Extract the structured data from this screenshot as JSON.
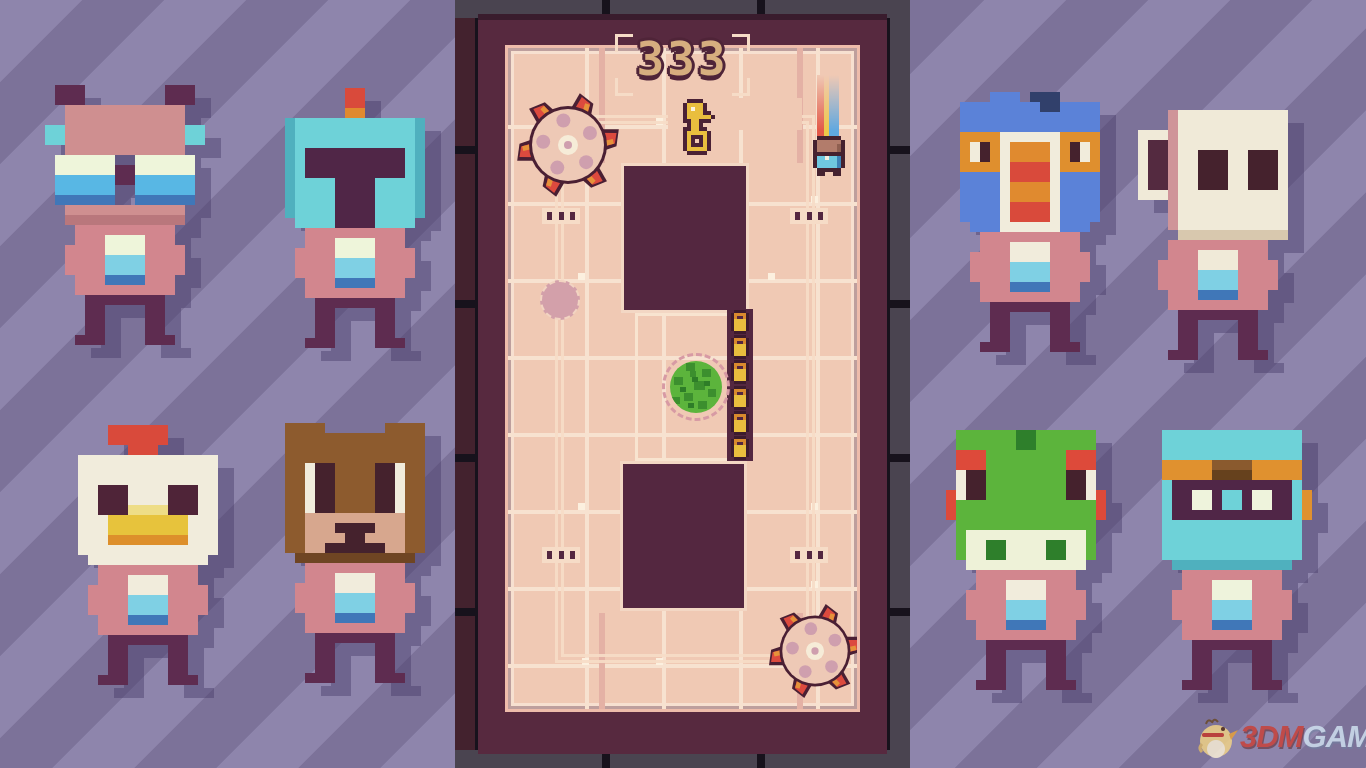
{
  "hud": {
    "score": "333"
  },
  "board": {
    "key_tokens": 6
  },
  "watermark": {
    "brand": "3DM",
    "suffix": "GAME"
  },
  "roster": {
    "left": [
      "bat",
      "knight",
      "chicken",
      "bear"
    ],
    "right": [
      "turkey",
      "mug",
      "frog",
      "aviator"
    ]
  },
  "palette": {
    "background_light": "#8e85ac",
    "background_dark": "#7c7299",
    "wall": "#57293f",
    "floor": "#f0c9b4",
    "pit": "#542740",
    "gold": "#e9be3e",
    "saw": {
      "outline": "#4a1f33",
      "red": "#dc4a3e",
      "orange": "#e6923a",
      "body": "#eec9b6",
      "petal": "#cf9fae",
      "core": "#f6ecd8"
    },
    "bush": {
      "leaf": "#5cb43c",
      "leafDark": "#3c8f2e",
      "leafDeep": "#2e7d28"
    },
    "watermark_red": "#c8413a",
    "watermark_blue": "#cfe0ef"
  },
  "sprites": {
    "char_bat": {
      "palette": {
        "E": "#5e2c50",
        "H": "#cf8f90",
        "h": "#b9777c",
        "C": "#6ed2d8",
        "W": "#eef5da",
        "U": "#58b7e4",
        "D": "#4077b8",
        "S": "#d2868e",
        "A": "#d2868e",
        "B": "#7fd0e4",
        "L": "#5e2c50"
      },
      "grid": [
        ".EEE........EEE.",
        ".EEE........EEE.",
        "..HHHHHHHHHHHH..",
        "..HHHHHHHHHHHH..",
        "CCHHHHHHHHHHHHCC",
        "CCHHHHHHHHHHHHCC",
        "..HHHHHHHHHHHH..",
        ".WWWWWW..WWWWWW.",
        ".WWWWWWEEWWWWWW.",
        ".UUUUUUEEUUUUUU.",
        ".UUUUUU..UUUUUU.",
        ".DDDDDD..DDDDDD.",
        "..HHHHHHHHHHHH..",
        "..hhhhhhhhhhhh..",
        "...SSSSSSSSSS...",
        "...SSSWWWWSSS...",
        "..ASSSWWWWSSSA..",
        "..ASSSBBBBSSSA..",
        "..ASSSBBBBSSSA..",
        "...SSSDDDDSSS...",
        "...SSSSSSSSSS...",
        "....LLLLLLLL....",
        "....LL....LL....",
        "....LL....LL....",
        "....LL....LL....",
        "...LLL....LLL..."
      ]
    },
    "char_knight": {
      "palette": {
        "R": "#d94a3b",
        "N": "#e08a2f",
        "K": "#6ed2d8",
        "k": "#4fb0be",
        "V": "#502647",
        "W": "#eef5da",
        "S": "#d2868e",
        "A": "#d2868e",
        "B": "#7fd0e4",
        "D": "#4077b8",
        "L": "#5e2c50"
      },
      "grid": [
        ".......RR.......",
        ".......RR.......",
        ".......NN.......",
        ".kKKKKKKKKKKKKk.",
        ".kKKKKKKKKKKKKk.",
        ".kKKKKKKKKKKKKk.",
        ".kKVVVVVVVVVVKk.",
        ".kKVVVVVVVVVVKk.",
        ".kKVVVVVVVVVVKk.",
        ".kKKKKVVVVKKKKk.",
        ".kKKKKVVVVKKKKk.",
        ".kKKKKVVVVKKKKk.",
        ".kKKKKVVVVKKKKk.",
        "..KKKKVVVVKKKK..",
        "...SSSSSSSSSS...",
        "...SSSWWWWSSS...",
        "..ASSSWWWWSSSA..",
        "..ASSSBBBBSSSA..",
        "..ASSSBBBBSSSA..",
        "...SSSDDDDSSS...",
        "...SSSSSSSSSS...",
        "....LLLLLLLL....",
        "....LL....LL....",
        "....LL....LL....",
        "....LL....LL....",
        "...LLL....LLL..."
      ]
    },
    "char_chicken": {
      "palette": {
        "R": "#d94a3b",
        "W": "#f1ecdc",
        "E": "#4f2438",
        "Y": "#eedd86",
        "y": "#e7c33c",
        "N": "#dd8f2b",
        "S": "#d2868e",
        "A": "#d2868e",
        "B": "#7fd0e4",
        "D": "#4077b8",
        "L": "#5e2c50"
      },
      "grid": [
        "....RRRRRR......",
        "....RRRRRR......",
        "......RRR.......",
        ".WWWWWWWWWWWWWW.",
        ".WWWWWWWWWWWWWW.",
        ".WWWWWWWWWWWWWW.",
        ".WWEEEWWWWEEEWW.",
        ".WWEEEWWWWEEEWW.",
        ".WWEEEYYYYEEEWW.",
        ".WWWyyyyyyyyWWW.",
        ".WWWyyyyyyyyWWW.",
        ".WWWNNNNNNNNWWW.",
        ".WWWWWWWWWWWWWW.",
        "..WWWWWWWWWWWW..",
        "...SSSSSSSSSS...",
        "...SSSWWWWSSS...",
        "..ASSSWWWWSSSA..",
        "..ASSSBBBBSSSA..",
        "..ASSSBBBBSSSA..",
        "...SSSDDDDSSS...",
        "...SSSSSSSSSS...",
        "....LLLLLLLL....",
        "....LL....LL....",
        "....LL....LL....",
        "....LL....LL....",
        "...LLL....LLL..."
      ]
    },
    "char_bear": {
      "palette": {
        "F": "#8d5b2e",
        "f": "#6f4523",
        "W": "#f1ecdc",
        "E": "#45222d",
        "M": "#d7a78e",
        "S": "#d2868e",
        "A": "#d2868e",
        "B": "#7fd0e4",
        "D": "#4077b8",
        "L": "#5e2c50"
      },
      "grid": [
        ".FFFF......FFFF.",
        ".FFFFFFFFFFFFFF.",
        ".FFFFFFFFFFFFFF.",
        ".FFFFFFFFFFFFFF.",
        ".FFWEEFFFFEEWFF.",
        ".FFWEEFFFFEEWFF.",
        ".FFWEEFFFFEEWFF.",
        ".FFWEEFFFFEEWFF.",
        ".FFWEEFFFFEEWFF.",
        ".FFMMMMMMMMMMFF.",
        ".FFMMMEEEEMMMFF.",
        ".FFMMMMEEMMMMFF.",
        ".FFMMEEEEEEMMFF.",
        "..ffffffffffff..",
        "...SSSSSSSSSS...",
        "...SSSWWWWSSS...",
        "..ASSSWWWWSSSA..",
        "..ASSSBBBBSSSA..",
        "..ASSSBBBBSSSA..",
        "...SSSDDDDSSS...",
        "...SSSSSSSSSS...",
        "....LLLLLLLL....",
        "....LL....LL....",
        "....LL....LL....",
        "....LL....LL....",
        "...LLL....LLL..."
      ]
    },
    "char_turkey": {
      "palette": {
        "U": "#5b82d8",
        "u": "#31406b",
        "N": "#df8f2e",
        "n": "#e08a2f",
        "r": "#d94a3b",
        "W": "#f1ecdc",
        "E": "#45222d",
        "S": "#d2868e",
        "A": "#d2868e",
        "B": "#7fd0e4",
        "D": "#4077b8",
        "L": "#5e2c50"
      },
      "grid": [
        "....UUU.uuu.....",
        ".UUUUUUUUuuUUUU.",
        ".UUUUUUUUUUUUUU.",
        ".UUUUUUUUUUUUUU.",
        ".NNNNWWWWWWNNNN.",
        ".NWENWnnnnWNEWN.",
        ".NWENWnnnnWNEWN.",
        ".NNNNWrrrrWNNNN.",
        ".UUUUWrrrrWUUUU.",
        ".UUUUWnnnnWUUUU.",
        ".UUUUWnnnnWUUUU.",
        ".UUUUWrrrrWUUUU.",
        ".UUUUWrrrrWUUUU.",
        "..UUUWWWWWWUUU..",
        "...SSSSSSSSSS...",
        "...SSSWWWWSSS...",
        "..ASSSWWWWSSSA..",
        "..ASSSBBBBSSSA..",
        "..ASSSBBBBSSSA..",
        "...SSSDDDDSSS...",
        "...SSSSSSSSSS...",
        "....LLLLLLLL....",
        "....LL....LL....",
        "....LL....LL....",
        "....LL....LL....",
        "...LLL....LLL..."
      ]
    },
    "char_mug": {
      "palette": {
        "W": "#f0ead8",
        "w": "#d8c8ae",
        "P": "#cf9499",
        "H": "#542a40",
        "E": "#45222d",
        "S": "#d2868e",
        "A": "#d2868e",
        "B": "#7fd0e4",
        "D": "#4077b8",
        "L": "#5e2c50"
      },
      "grid": [
        "................",
        "...PWWWWWWWWWWW.",
        "...PWWWWWWWWWWW.",
        "WWWPWWWWWWWWWWW.",
        "WHHPWWWWWWWWWWW.",
        "WHHPWWEEEWWEEEW.",
        "WHHPWWEEEWWEEEW.",
        "WHHPWWEEEWWEEEW.",
        "WHHPWWEEEWWEEEW.",
        "WWWPWWWWWWWWWWW.",
        "...PWWWWWWWWWWW.",
        "...PWWWWWWWWWWW.",
        "...PWWWWWWWWWWW.",
        "....wwwwwwwwwww.",
        "...SSSSSSSSSS...",
        "...SSSWWWWSSS...",
        "..ASSSWWWWSSSA..",
        "..ASSSBBBBSSSA..",
        "..ASSSBBBBSSSA..",
        "...SSSDDDDSSS...",
        "...SSSSSSSSSS...",
        "....LLLLLLLL....",
        "....LL....LL....",
        "....LL....LL....",
        "....LL....LL....",
        "...LLL....LLL..."
      ]
    },
    "char_frog": {
      "palette": {
        "G": "#5cb43c",
        "g": "#2e7f2b",
        "R": "#dd4a3a",
        "W": "#f1ecdc",
        "E": "#45222d",
        "C": "#eef2d8",
        "S": "#d2868e",
        "A": "#d2868e",
        "B": "#7fd0e4",
        "D": "#4077b8",
        "L": "#5e2c50"
      },
      "grid": [
        ".GGGGGGggGGGGGG.",
        ".GGGGGGggGGGGGG.",
        ".RRRGGGGGGGGRRR.",
        ".RRRGGGGGGGGRRR.",
        ".WEEGGGGGGGGEEW.",
        ".WEEGGGGGGGGEEW.",
        "RWEEGGGGGGGGEEWR",
        "RGGGGGGGGGGGGGGR",
        "RGGGGGGGGGGGGGGR",
        ".GGGGGGGGGGGGGG.",
        ".GCCCCCCCCCCCCG.",
        ".GCCggCCCCggCCG.",
        ".GCCggCCCCggCCG.",
        "..CCCCCCCCCCCC..",
        "...SSSSSSSSSS...",
        "...SSSWWWWSSS...",
        "..ASSSWWWWSSSA..",
        "..ASSSBBBBSSSA..",
        "..ASSSBBBBSSSA..",
        "...SSSDDDDSSS...",
        "...SSSSSSSSSS...",
        "....LLLLLLLL....",
        "....LL....LL....",
        "....LL....LL....",
        "....LL....LL....",
        "...LLL....LLL..."
      ]
    },
    "char_aviator": {
      "palette": {
        "T": "#6ed2d8",
        "t": "#4fb0be",
        "N": "#e0912f",
        "F": "#8a5a2e",
        "f": "#66411d",
        "V": "#502647",
        "W": "#eef3dc",
        "S": "#d2868e",
        "A": "#d2868e",
        "B": "#7fd0e4",
        "D": "#4077b8",
        "L": "#5e2c50"
      },
      "grid": [
        ".TTTTTTTTTTTTTT.",
        ".TTTTTTTTTTTTTT.",
        ".TTTTTTTTTTTTTT.",
        ".NNNNNFFFFNNNNN.",
        ".NNNNNffffNNNNN.",
        ".TVVVVVVVVVVVVT.",
        ".TVVWWVTTVWWVVTN",
        ".TVVWWVTTVWWVVTN",
        ".TVVVVVVVVVVVVTN",
        ".TTTTTTTTTTTTTT.",
        ".TTTTTTTTTTTTTT.",
        ".TTTTTTTTTTTTTT.",
        ".TTTTTTTTTTTTTT.",
        "..tttttttttttt..",
        "...SSSSSSSSSS...",
        "...SSSWWWWSSS...",
        "..ASSSWWWWSSSA..",
        "..ASSSBBBBSSSA..",
        "..ASSSBBBBSSSA..",
        "...SSSDDDDSSS...",
        "...SSSSSSSSSS...",
        "....LLLLLLLL....",
        "....LL....LL....",
        "....LL....LL....",
        "....LL....LL....",
        "...LLL....LLL..."
      ]
    },
    "cat": {
      "palette": {
        "O": "#45212f",
        "H": "#b27c6b",
        "h": "#8f5f50",
        "B": "#6fc8e0",
        "b": "#3e83b8",
        "W": "#f5efdf"
      },
      "grid": [
        ".OOOOOO..",
        "OHHHHHHO.",
        "OHHHHHhO.",
        "OHHHHHhO.",
        "OOOOOOOO.",
        "OBBWBBbO.",
        "OBBBBBbO.",
        "OBBBBBbO.",
        ".OOOOOO..",
        ".OO..OO.."
      ]
    },
    "key": {
      "palette": {
        "O": "#4a2135",
        "K": "#e9be3e",
        "k": "#cf8f2a",
        "W": "#fbf2dc"
      },
      "grid": [
        "..OOOO....",
        ".OKKKKO...",
        ".OKWKKO...",
        ".OKKKKOO..",
        ".OKKKKKKO.",
        ".OOKKOOO..",
        "..OKKO....",
        ".OOKKOO...",
        ".OKKKKKO..",
        ".OKOOOKO..",
        ".OKO.OKO..",
        ".OKOOOKO..",
        ".OKKKKKO..",
        "..OOOOO..."
      ]
    },
    "token_key": {
      "palette": {
        "O": "#3d1b2d",
        "k": "#d98a2e",
        "K": "#e9be3e",
        "H": "#542740"
      },
      "grid": [
        ".OOOO.",
        "OkkkkO",
        "OkHHkO",
        "OKKKKO",
        "OKKKKO",
        "OKKKKO",
        "OKKKKO",
        ".OOOO."
      ]
    }
  }
}
